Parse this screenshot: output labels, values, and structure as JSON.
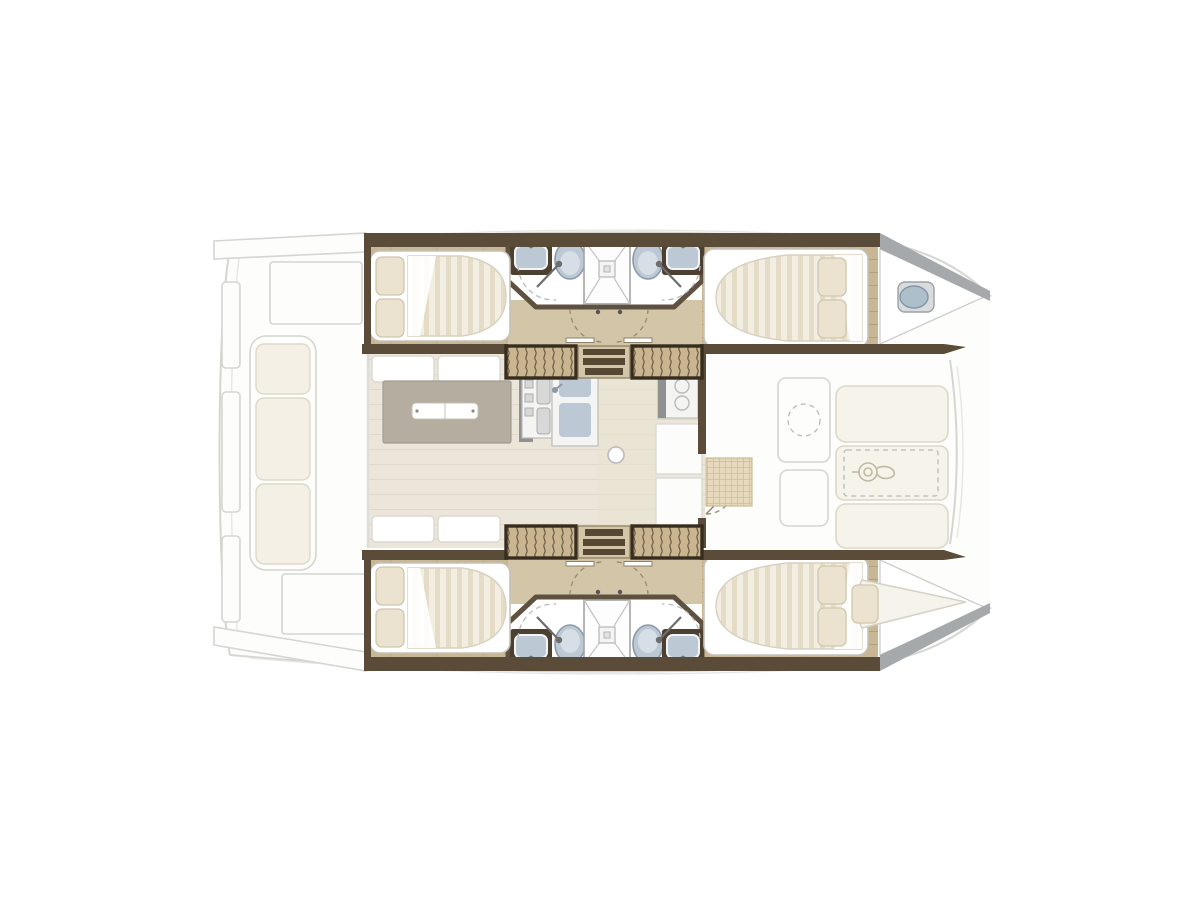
{
  "meta": {
    "title": "Catamaran accommodation floor plan (top-down)",
    "view": "overhead deck and interior layout, bow to the right"
  },
  "colors": {
    "ghost_fill": "#fdfdfc",
    "ghost_line": "#d5d5d2",
    "ghost_line2": "#e6e6e3",
    "cushion": "#f4f0e5",
    "cushion_line": "#ded9c9",
    "pad": "#f6f3ea",
    "pad_line": "#ddd8c8",
    "hull_wall": "#5a4c39",
    "bow_wall": "#a6a9ab",
    "wood": "#c8b694",
    "wood_line": "#b2a07d",
    "corridor": "#d3c5a8",
    "stair": "#c9b691",
    "stair_line": "#6a5941",
    "stair_frame": "#362d1e",
    "bath": "#ffffff",
    "bath_wall": "#5f5140",
    "fixture_blue": "#bcc9d4",
    "fixture_blue_dark": "#8a9aa8",
    "fixture_lid": "#d6dfe6",
    "sink_counter": "#4c4030",
    "frame_white": "#ffffff",
    "mattress": "#f3eee2",
    "mattress_stripe": "#e5dcc8",
    "pillow": "#ebe3cf",
    "saloon_floor": "#ece6da",
    "saloon_line": "#e0d8c9",
    "table": "#b4ada0",
    "galley_gray": "#909090",
    "steel": "#d9dbdd",
    "mat": "#e7d9bc"
  },
  "plan": {
    "vessel": "sailing catamaran",
    "symmetry": "port and starboard hulls mirrored about centerline",
    "hulls": [
      {
        "name": "port-hull",
        "areas": [
          "aft-double-cabin",
          "aft-head",
          "shared-shower-stall",
          "forward-head",
          "forward-double-cabin",
          "bow-washbasin"
        ],
        "fixtures": [
          "island-double-bed",
          "toilet",
          "washbasin",
          "shower",
          "companionway-steps"
        ]
      },
      {
        "name": "starboard-hull",
        "areas": [
          "aft-double-cabin",
          "aft-head",
          "shared-shower-stall",
          "forward-head",
          "forward-double-cabin",
          "bow-single-berth"
        ],
        "fixtures": [
          "island-double-bed",
          "toilet",
          "washbasin",
          "shower",
          "companionway-steps"
        ]
      }
    ],
    "saloon": [
      "dinette-table",
      "sofa-benches",
      "galley-stove",
      "galley-double-sink",
      "cabinets",
      "forward-door",
      "entry-mat"
    ],
    "aft_deck": [
      "cockpit-bench-with-cushions",
      "cockpit-table",
      "storage-lockers"
    ],
    "foredeck": [
      "sun-pads",
      "windlass",
      "anchor-locker",
      "door-panel"
    ]
  }
}
